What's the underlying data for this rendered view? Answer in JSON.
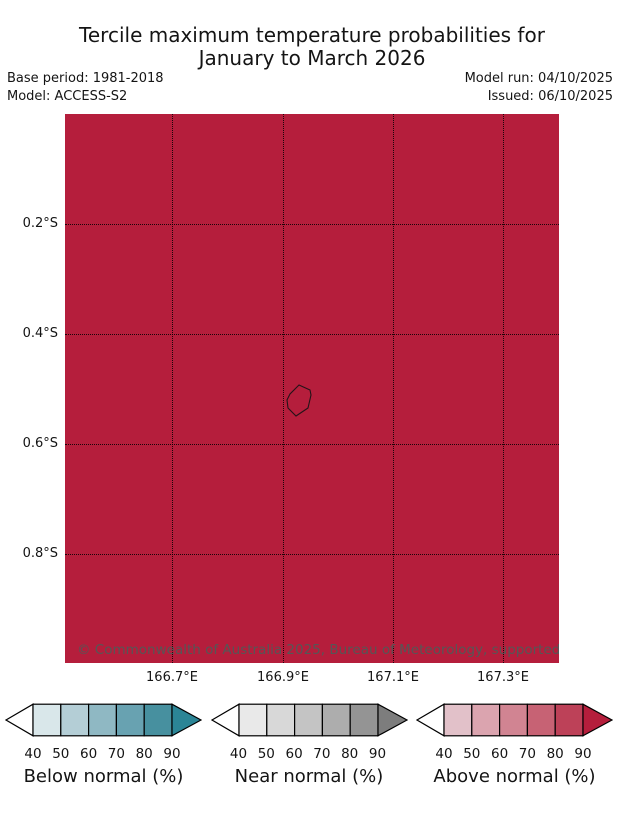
{
  "header": {
    "title_line1": "Tercile maximum temperature probabilities for",
    "title_line2": "January to March 2026",
    "base_period": "Base period: 1981-2018",
    "model": "Model: ACCESS-S2",
    "model_run": "Model run: 04/10/2025",
    "issued": "Issued: 06/10/2025"
  },
  "map": {
    "fill_color": "#b51e3c",
    "x_ticks": [
      "166.7°E",
      "166.9°E",
      "167.1°E",
      "167.3°E"
    ],
    "y_ticks": [
      "0.2°S",
      "0.4°S",
      "0.6°S",
      "0.8°S"
    ],
    "copyright": "© Commonwealth of Australia 2025, Bureau of Meteorology, supported by COSPPac"
  },
  "colorbars": [
    {
      "caption": "Below normal (%)",
      "ticks": [
        "40",
        "50",
        "60",
        "70",
        "80",
        "90"
      ],
      "segment_colors": [
        "#d9e7ea",
        "#b4ced6",
        "#8fb8c3",
        "#68a2b1",
        "#47909f"
      ],
      "left_arrow_color": "#ffffff",
      "right_arrow_color": "#2b8596"
    },
    {
      "caption": "Near normal (%)",
      "ticks": [
        "40",
        "50",
        "60",
        "70",
        "80",
        "90"
      ],
      "segment_colors": [
        "#e9e9e9",
        "#d8d8d8",
        "#c4c4c4",
        "#adadad",
        "#949494"
      ],
      "left_arrow_color": "#ffffff",
      "right_arrow_color": "#7d7d7d"
    },
    {
      "caption": "Above normal (%)",
      "ticks": [
        "40",
        "50",
        "60",
        "70",
        "80",
        "90"
      ],
      "segment_colors": [
        "#e2c1c9",
        "#dba4af",
        "#d18492",
        "#c76274",
        "#bd4158"
      ],
      "left_arrow_color": "#ffffff",
      "right_arrow_color": "#b51e3c"
    }
  ],
  "chart_data": {
    "type": "heatmap",
    "title": "Tercile maximum temperature probabilities for January to March 2026",
    "x_ticks": [
      "166.7°E",
      "166.9°E",
      "167.1°E",
      "167.3°E"
    ],
    "y_ticks": [
      "0.2°S",
      "0.4°S",
      "0.6°S",
      "0.8°S"
    ],
    "value": "Above normal probability > 90% over entire map extent",
    "legend": [
      "Below normal (%)",
      "Near normal (%)",
      "Above normal (%)"
    ],
    "legend_tick_range": [
      40,
      90
    ],
    "grid": "dotted"
  }
}
